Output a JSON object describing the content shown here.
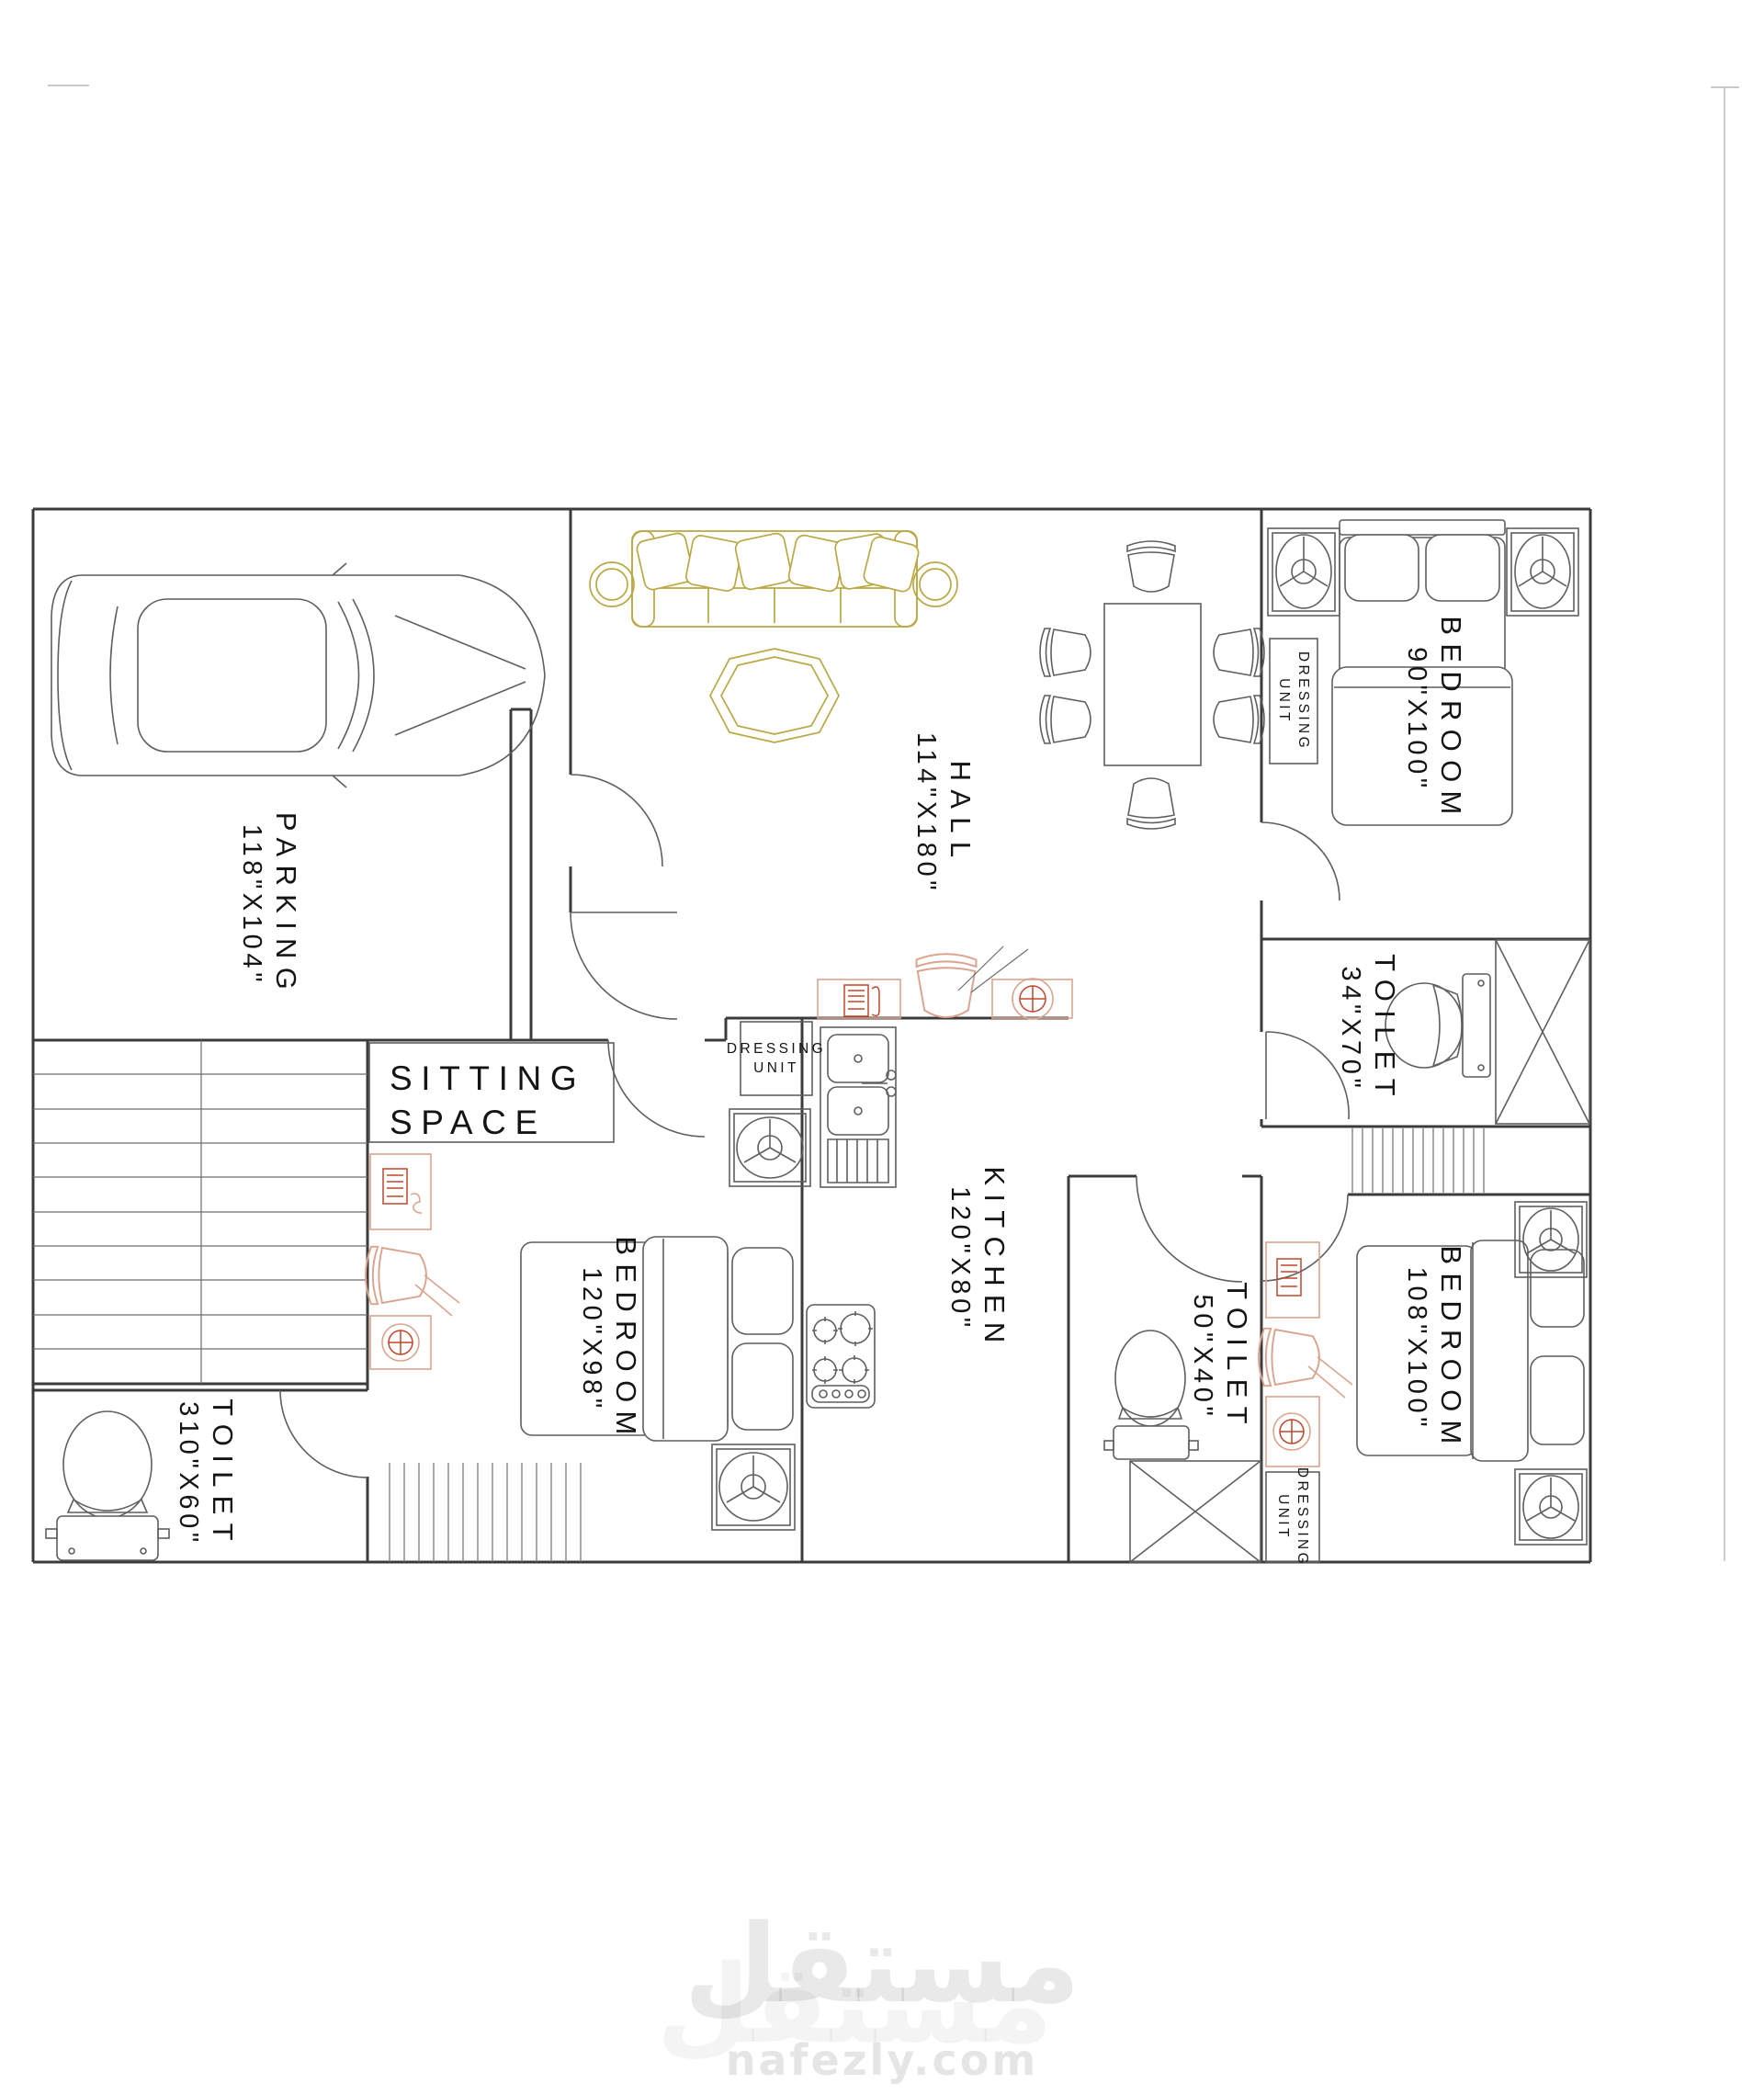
{
  "labels": {
    "parking": {
      "name": "PARKING",
      "dims": "118\"X104\""
    },
    "hall": {
      "name": "HALL",
      "dims": "114\"X180\""
    },
    "bedroom90": {
      "name": "BEDROOM",
      "dims": "90\"X100\""
    },
    "toilet34": {
      "name": "TOILET",
      "dims": "34\"X70\""
    },
    "sitting": {
      "line1": "SITTING",
      "line2": "SPACE"
    },
    "kitchen": {
      "name": "KITCHEN",
      "dims": "120\"X80\""
    },
    "bedroom120": {
      "name": "BEDROOM",
      "dims": "120\"X98\""
    },
    "toilet50": {
      "name": "TOILET",
      "dims": "50\"X40\""
    },
    "bedroom108": {
      "name": "BEDROOM",
      "dims": "108\"X100\""
    },
    "toilet310": {
      "name": "TOILET",
      "dims": "310\"X60\""
    },
    "dressing_bedroom90": {
      "line1": "DRESSING",
      "line2": "UNIT"
    },
    "dressing_bedroom120": {
      "line1": "DRESSING",
      "line2": "UNIT"
    },
    "dressing_bedroom108": {
      "line1": "DRESSING",
      "line2": "UNIT"
    }
  },
  "watermark": {
    "brand_arabic": "مستقل",
    "site": "nafezly.com"
  },
  "colors": {
    "wall": "#3b3b3b",
    "furniture_line": "#5f5f5f",
    "sofa_accent": "#b9a845",
    "fixture_accent": "#dba48e",
    "icon_red": "#c0452a",
    "label_text": "#141414",
    "watermark_gray": "#e8e8e8"
  }
}
